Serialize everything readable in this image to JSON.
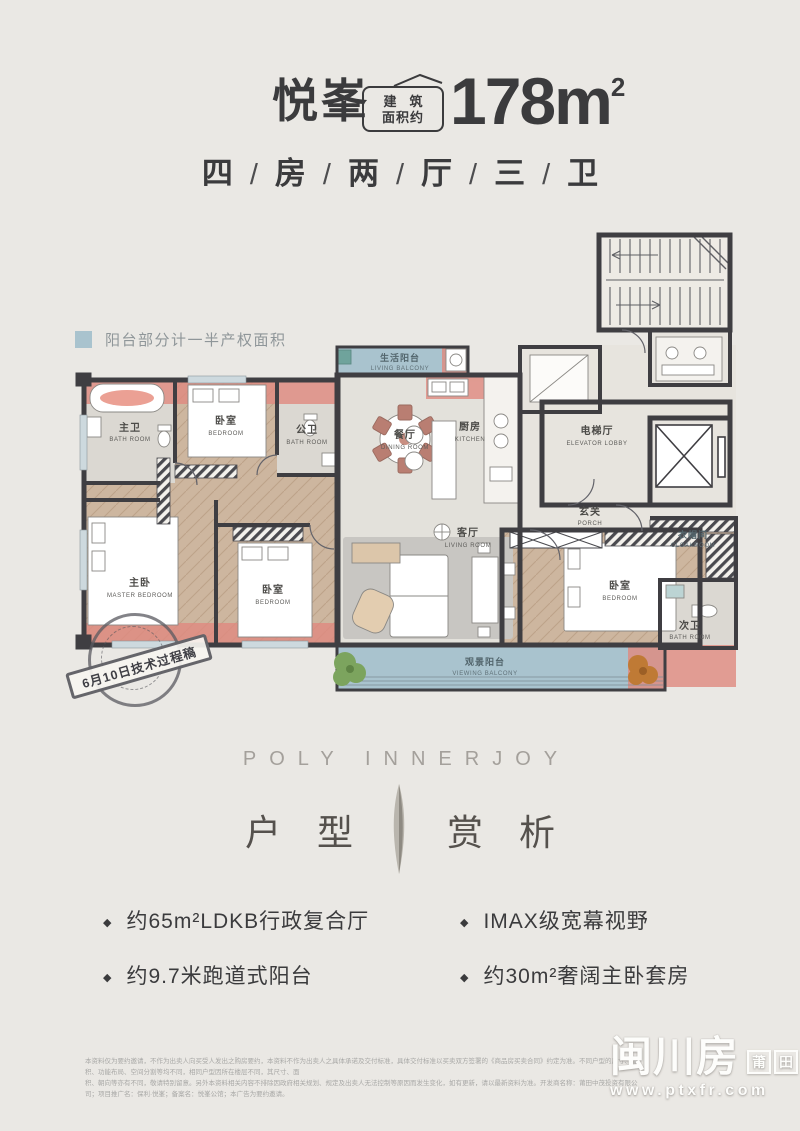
{
  "header": {
    "title": "悦峯",
    "badge_line1": "建　筑",
    "badge_line2": "面积约",
    "area_value": "178m",
    "area_sup": "2",
    "subtitle_chars": [
      "四",
      "房",
      "两",
      "厅",
      "三",
      "卫"
    ],
    "subtitle_separator": "/"
  },
  "legend": {
    "label": "阳台部分计一半产权面积",
    "swatch_color": "#a9c3ce"
  },
  "plan": {
    "stamp_text": "6月10日技术过程稿",
    "rooms": [
      {
        "zh": "主卫",
        "en": "BATH ROOM"
      },
      {
        "zh": "卧室",
        "en": "BEDROOM"
      },
      {
        "zh": "公卫",
        "en": "BATH ROOM"
      },
      {
        "zh": "生活阳台",
        "en": "LIVING BALCONY"
      },
      {
        "zh": "餐厅",
        "en": "DINING ROOM"
      },
      {
        "zh": "厨房",
        "en": "KITCHEN"
      },
      {
        "zh": "电梯厅",
        "en": "ELEVATOR LOBBY"
      },
      {
        "zh": "玄关",
        "en": "PORCH"
      },
      {
        "zh": "主卧",
        "en": "MASTER BEDROOM"
      },
      {
        "zh": "卧室",
        "en": "BEDROOM"
      },
      {
        "zh": "客厅",
        "en": "LIVING ROOM"
      },
      {
        "zh": "卧室",
        "en": "BEDROOM"
      },
      {
        "zh": "衣帽间",
        "en": "CLOAKROOM"
      },
      {
        "zh": "次卫",
        "en": "BATH ROOM"
      },
      {
        "zh": "观景阳台",
        "en": "VIEWING BALCONY"
      }
    ]
  },
  "section": {
    "brand": "POLY INNERJOY",
    "heading_left": "户型",
    "heading_right": "赏析"
  },
  "features": {
    "bullet": "◆",
    "items": [
      "约65m²LDKB行政复合厅",
      "约9.7米跑道式阳台",
      "IMAX级宽幕视野",
      "约30m²奢阔主卧套房"
    ]
  },
  "footer": {
    "disclaimer_line1": "本资料仅为要约邀请，不作为出卖人向买受人发出之购房要约，本资料不作为出卖人之具体承诺及交付标准，具体交付标准以买卖双方签署的《商品房买卖合同》约定为准。不同户型的尺寸、面积、功能布局、空间分割等均不同，相同户型因所在楼层不同，其尺寸、面",
    "disclaimer_line2": "积、朝向等亦有不同，敬请特别留意。另外本资料相关内容不排除因政府相关规划、规定及出卖人无法控制等原因而发生变化，如有更新，请以最新资料为准。开发商名称：莆田中茂投资有限公司；项目推广名：保利·悦峯；备案名：悦峯公馆；本广告为要约邀请。"
  },
  "watermark": {
    "big": "闽川房",
    "box1": "莆",
    "box2": "田",
    "url": "www.ptxfr.com"
  },
  "colors": {
    "balcony_blue": "#a9c3ce",
    "highlight_salmon": "#e08a7f",
    "wall": "#3f3e42",
    "wood": "#cdb69f"
  }
}
